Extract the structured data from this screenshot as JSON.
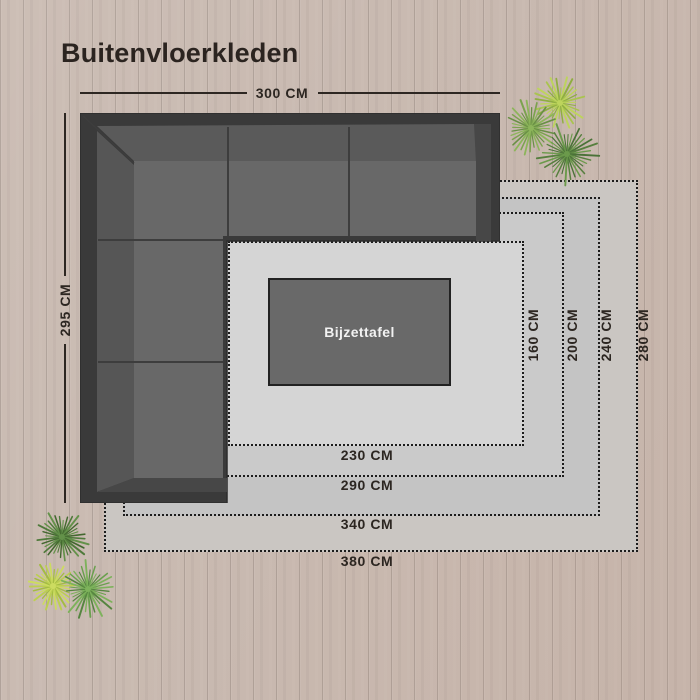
{
  "title": "Buitenvloerkleden",
  "sofa": {
    "width_label": "300 CM",
    "depth_label": "295 CM"
  },
  "side_table": {
    "label": "Bijzettafel"
  },
  "rugs": [
    {
      "width_label": "380 CM",
      "height_label": "280 CM"
    },
    {
      "width_label": "340 CM",
      "height_label": "240 CM"
    },
    {
      "width_label": "290 CM",
      "height_label": "200 CM"
    },
    {
      "width_label": "230 CM",
      "height_label": "160 CM"
    }
  ],
  "colors": {
    "wood": "#c9bab1",
    "plank_line": "#ab9c93",
    "rug_shades": [
      "#cac6c2",
      "#c4c4c4",
      "#cacaca",
      "#d5d5d5"
    ],
    "dotted_border": "#1c1c1c",
    "sofa_frame": "#3a3a3a",
    "sofa_backrest": "#5a5a5a",
    "sofa_seat": "#686868",
    "table_fill": "#696969",
    "label_text": "#2c2621",
    "table_text": "#f2f2f2",
    "plant_greens": [
      "#bdd45c",
      "#7ba24f",
      "#567f3e"
    ]
  }
}
